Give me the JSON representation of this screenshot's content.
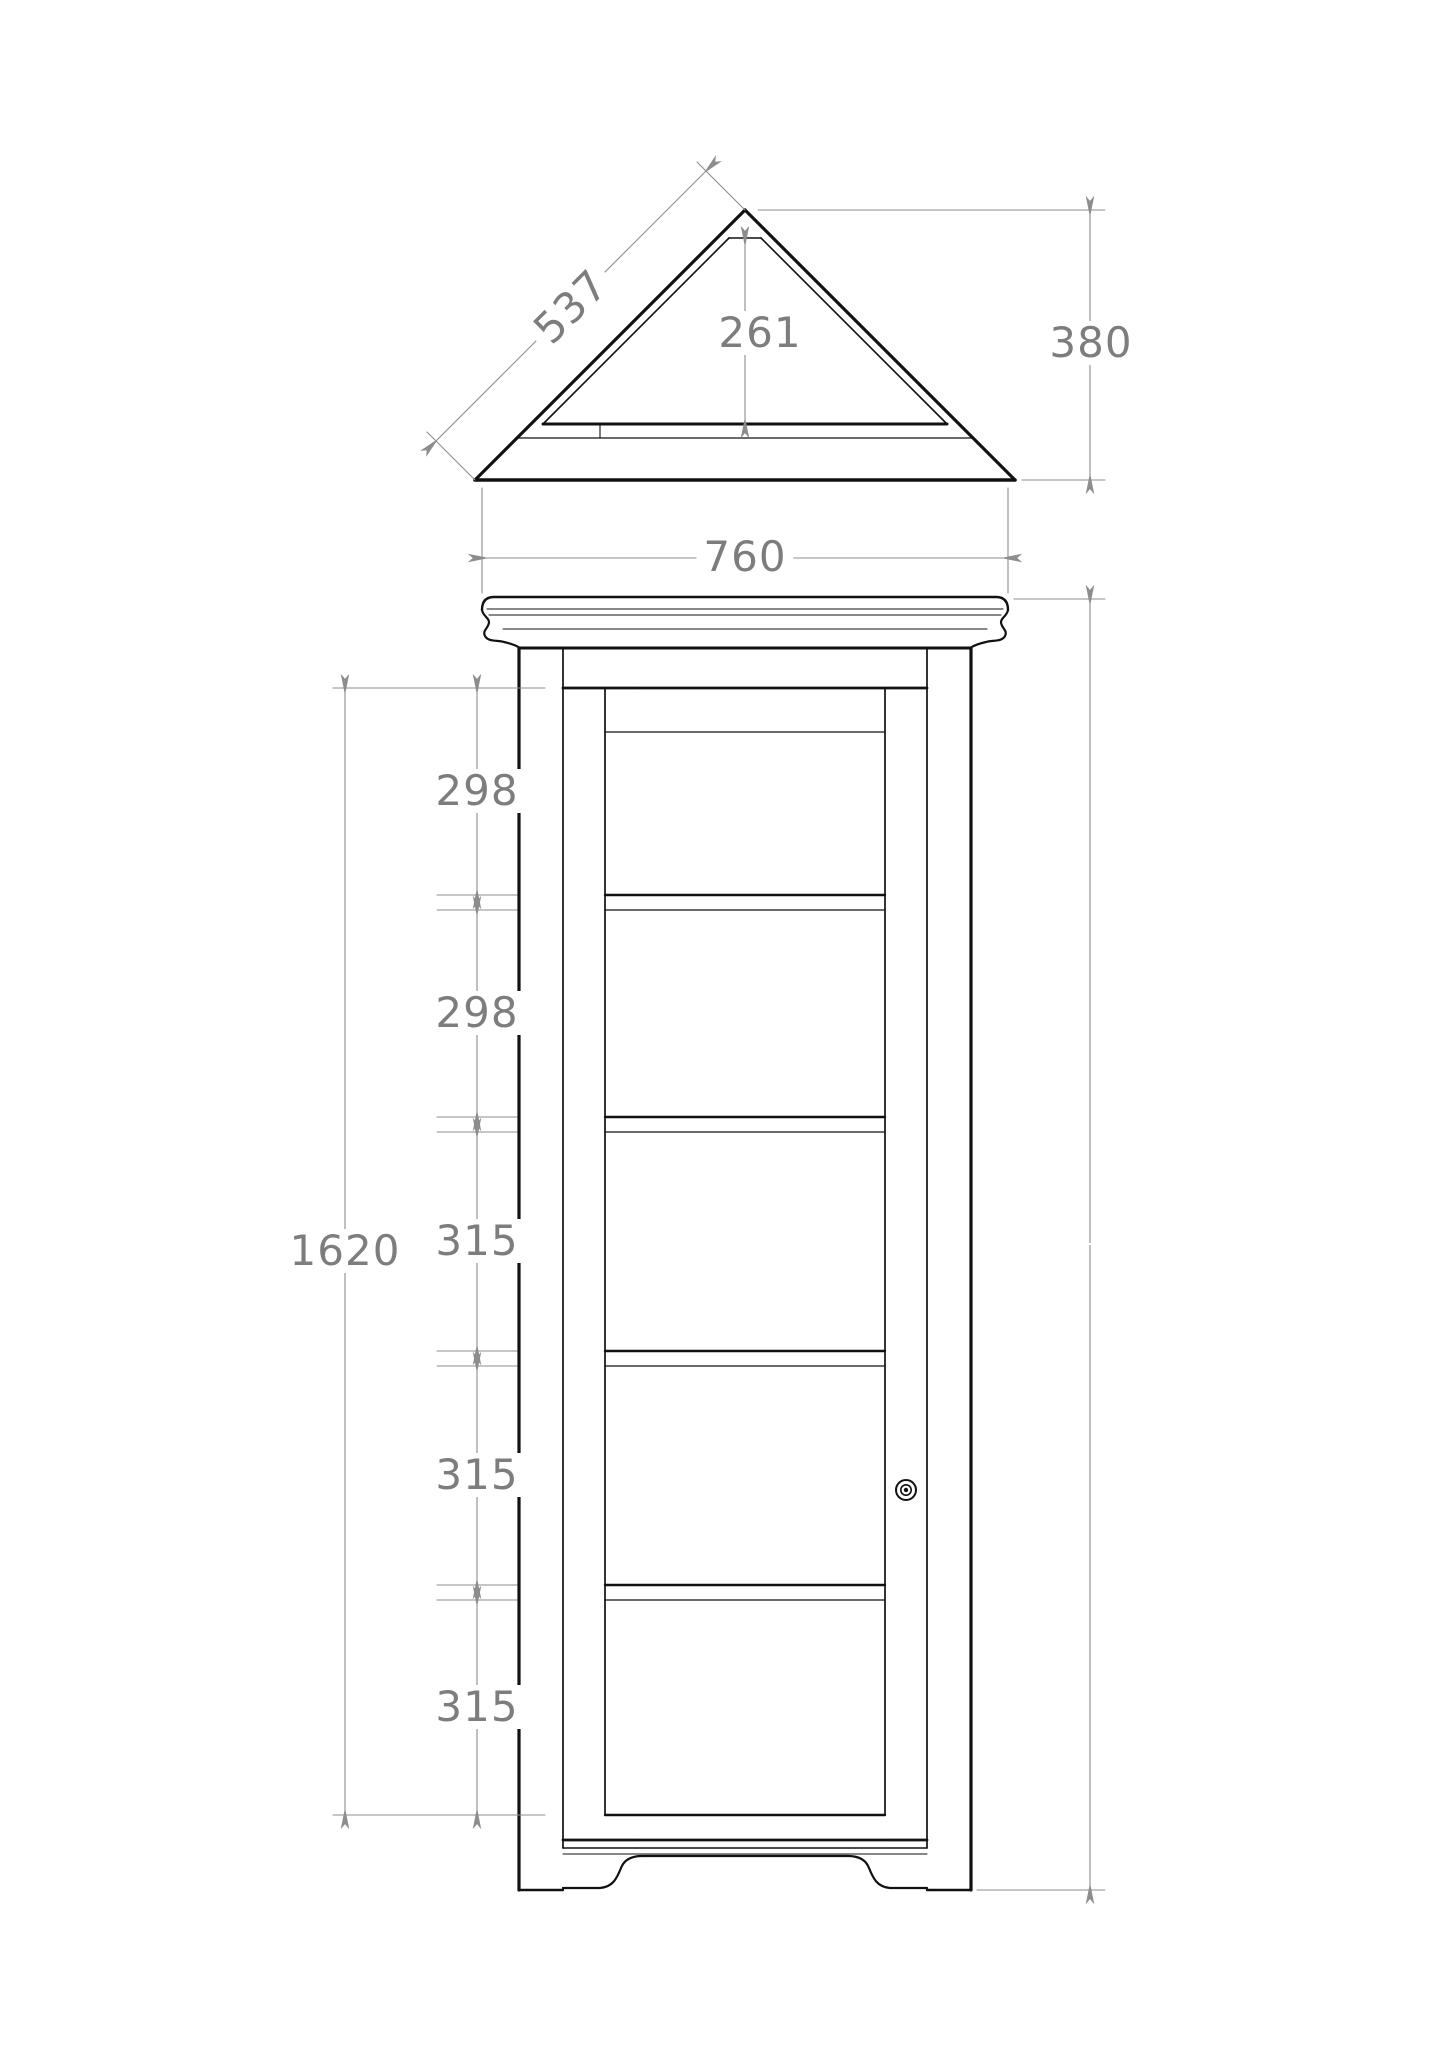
{
  "sheet": {
    "background_color": "#ffffff",
    "object_line_color": "#111111",
    "dimension_color": "#8d8d8d",
    "dimension_text_color": "#7d7d7d"
  },
  "plan_view": {
    "description": "top view of corner cabinet (right-angled triangle plan)",
    "dims": {
      "slant_side_width": "537",
      "inner_depth": "261",
      "overall_depth": "380"
    }
  },
  "elevation_view": {
    "description": "front elevation of corner display cabinet with glazed door, four shelves, cornice and bracket feet",
    "dims": {
      "front_width": "760",
      "overall_height": "1870",
      "door_opening_height": "1620",
      "shelf_spacings": [
        "298",
        "298",
        "315",
        "315",
        "315"
      ]
    }
  }
}
